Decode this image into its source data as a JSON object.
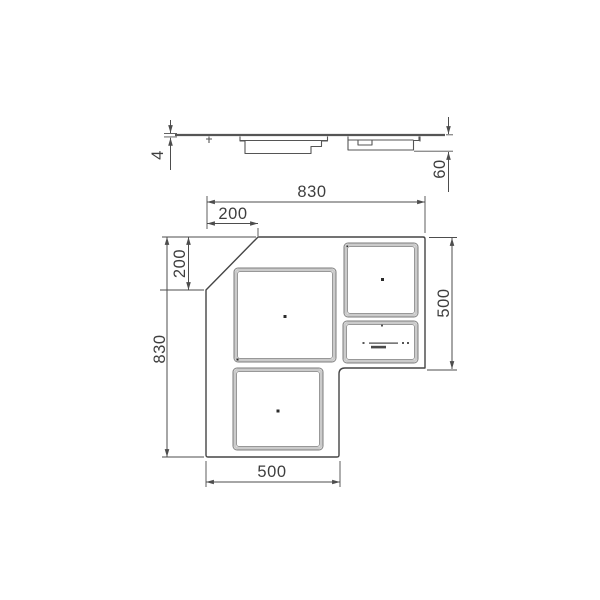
{
  "side_view": {
    "glass_thickness_label": "4",
    "body_depth_label": "60"
  },
  "plan_view": {
    "overall_width_label": "830",
    "overall_height_label": "830",
    "chamfer_width_label": "200",
    "chamfer_height_label": "200",
    "right_arm_depth_label": "500",
    "bottom_arm_width_label": "500"
  },
  "colors": {
    "background": "#ffffff",
    "outline_stroke": "#454545",
    "dimension_stroke": "#4d4d4d",
    "dimension_text": "#3e3e3e",
    "zone_frame": "#7e7e7e",
    "zone_band": "#cbcbcb"
  }
}
